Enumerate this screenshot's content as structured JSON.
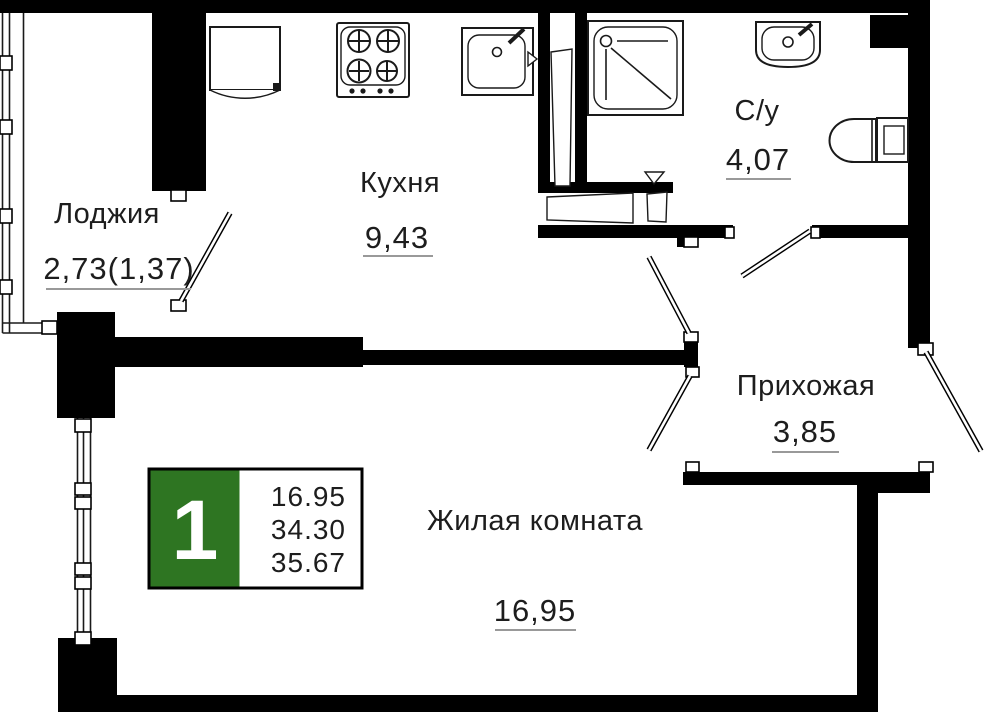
{
  "plan": {
    "rooms": [
      {
        "id": "loggia",
        "name": "Лоджия",
        "area": "2,73(1,37)"
      },
      {
        "id": "kitchen",
        "name": "Кухня",
        "area": "9,43"
      },
      {
        "id": "bath",
        "name": "С/у",
        "area": "4,07"
      },
      {
        "id": "hall",
        "name": "Прихожая",
        "area": "3,85"
      },
      {
        "id": "living",
        "name": "Жилая комната",
        "area": "16,95"
      }
    ],
    "badge": {
      "rooms_count": "1",
      "values": [
        "16.95",
        "34.30",
        "35.67"
      ]
    },
    "colors": {
      "badge_green": "#2e7522",
      "walls": "#000000",
      "text": "#1d1d1d",
      "underline": "#999999",
      "background": "#ffffff"
    }
  }
}
